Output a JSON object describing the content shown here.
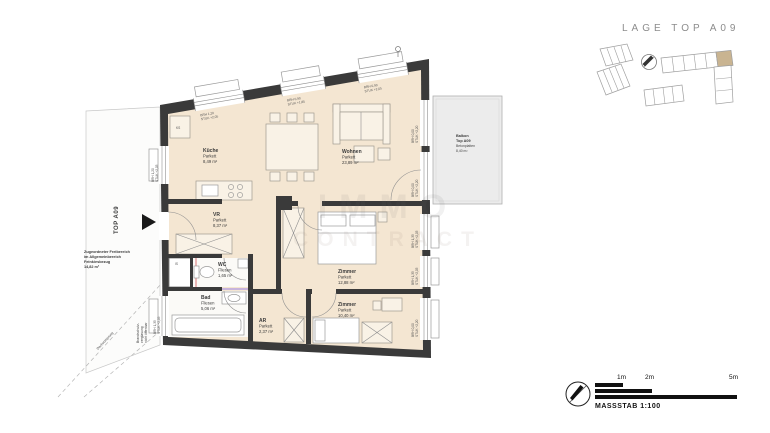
{
  "site": {
    "title": "LAGE TOP A09"
  },
  "watermark": {
    "line1": "IMMO",
    "line2": "CONTRACT"
  },
  "plan": {
    "rooms": [
      {
        "id": "kueche",
        "name": "Küche",
        "floor": "Parkett",
        "area": "8,49 m²"
      },
      {
        "id": "wohnen",
        "name": "Wohnen",
        "floor": "Parkett",
        "area": "23,89 m²"
      },
      {
        "id": "vr",
        "name": "VR",
        "floor": "Parkett",
        "area": "8,37 m²"
      },
      {
        "id": "wc",
        "name": "WC",
        "floor": "Fliesen",
        "area": "1,65 m²"
      },
      {
        "id": "bad",
        "name": "Bad",
        "floor": "Fliesen",
        "area": "5,06 m²"
      },
      {
        "id": "ar",
        "name": "AR",
        "floor": "Parkett",
        "area": "2,37 m²"
      },
      {
        "id": "zimmer1",
        "name": "Zimmer",
        "floor": "Parkett",
        "area": "12,88 m²"
      },
      {
        "id": "zimmer2",
        "name": "Zimmer",
        "floor": "Parkett",
        "area": "10,40 m²"
      }
    ],
    "balcony": {
      "name": "Balkon",
      "unit": "Top A09",
      "floor": "Betonplatten",
      "area": "8,40 m²"
    },
    "freibereich": {
      "line1": "Zugeordneter Freibereich",
      "line2": "im Allgemeinbereich",
      "line3": "Feinkiesbezug",
      "area": "14,82 m²"
    },
    "unit_label": "TOP A09",
    "fixtures": {
      "ks": "KS",
      "is": "IS"
    },
    "notes": {
      "brandschutz1": "Brandschutz-",
      "brandschutz2": "verglasung",
      "brandschutz3": "nicht öffenbar",
      "dach": "Dachvorsprung"
    },
    "window_labels": [
      {
        "l1": "BRH 1,20",
        "l2": "STUK +2,05"
      },
      {
        "l1": "BRH 0,90",
        "l2": "STUK +1,85"
      },
      {
        "l1": "BRH 0,90",
        "l2": "STUK +2,05"
      },
      {
        "l1": "BRH 0,00",
        "l2": "STUK +2,20"
      },
      {
        "l1": "BRH 0,00",
        "l2": "STUK +2,20"
      },
      {
        "l1": "BRH 1,35",
        "l2": "STUK +2,05"
      },
      {
        "l1": "BRH 1,35",
        "l2": "STUK +2,05"
      },
      {
        "l1": "BRH 0,00",
        "l2": "STUK +2,20"
      },
      {
        "l1": "BRH 1,20",
        "l2": "STUK +2,05"
      },
      {
        "l1": "BRH 1,35",
        "l2": "STUK +2,05"
      }
    ]
  },
  "scalebar": {
    "m1": "1m",
    "m2": "2m",
    "m5": "5m",
    "caption": "MASSSTAB 1:100"
  },
  "colors": {
    "floor": "#f4e6d2",
    "wall": "#3a3a3a",
    "balcony": "#ececec",
    "site_highlight": "#c9b491",
    "plumbing_purple": "#b9a3e0",
    "plumbing_pink": "#e08a8a",
    "scale_black": "#111111"
  }
}
